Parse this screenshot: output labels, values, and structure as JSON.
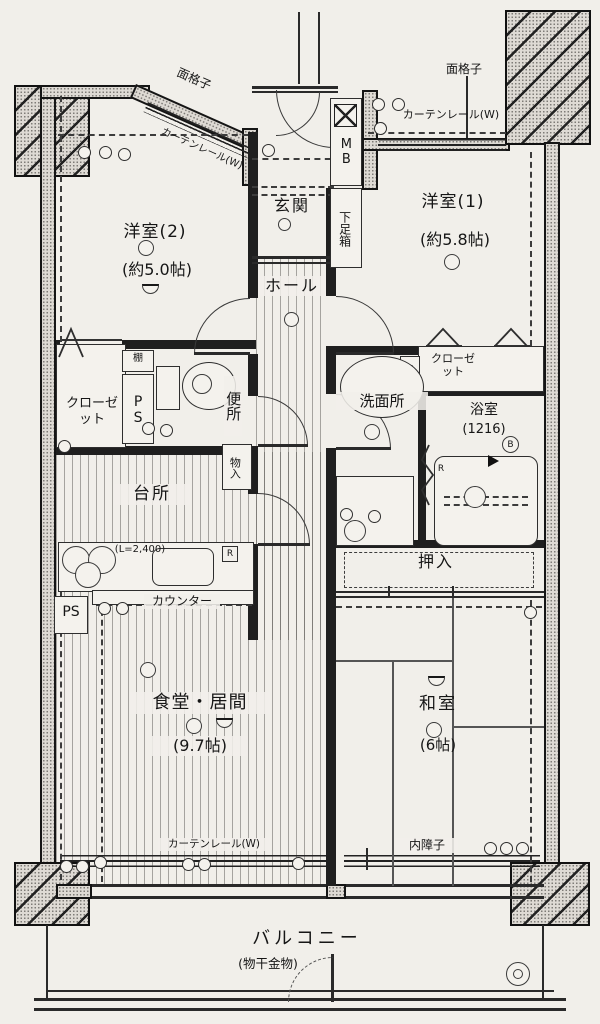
{
  "colors": {
    "paper": "#f1efea",
    "ink": "#1c1c1c",
    "wall_fill": "#dedad4"
  },
  "labels": {
    "mengoshi_tl": "面格子",
    "curtain_tl": "カーテンレール(W)",
    "mengoshi_tr": "面格子",
    "curtain_tr": "カーテンレール(W)",
    "mb": "MB",
    "genkan": "玄関",
    "getabako": "下足箱",
    "yo1_name": "洋室(1)",
    "yo1_size": "(約5.8帖)",
    "yo2_name": "洋室(2)",
    "yo2_size": "(約5.0帖)",
    "hall": "ホール",
    "closet_left": "クローゼット",
    "closet_right": "クローゼット",
    "tana": "棚",
    "ps": "PS",
    "benjo": "便所",
    "monoiri": "物入",
    "senmenjo": "洗面所",
    "bath_name": "浴室",
    "bath_size": "(1216)",
    "b_mark": "B",
    "r_mark": "R",
    "daidokoro": "台所",
    "counter_len": "(L=2,400)",
    "counter": "カウンター",
    "oshiire": "押入",
    "dining_name": "食堂・居間",
    "dining_size": "(9.7帖)",
    "washitsu_name": "和室",
    "washitsu_size": "(6帖)",
    "uchishoji": "内障子",
    "curtain_bottom": "カーテンレール(W)",
    "balcony_name": "バルコニー",
    "balcony_note": "(物干金物)"
  }
}
